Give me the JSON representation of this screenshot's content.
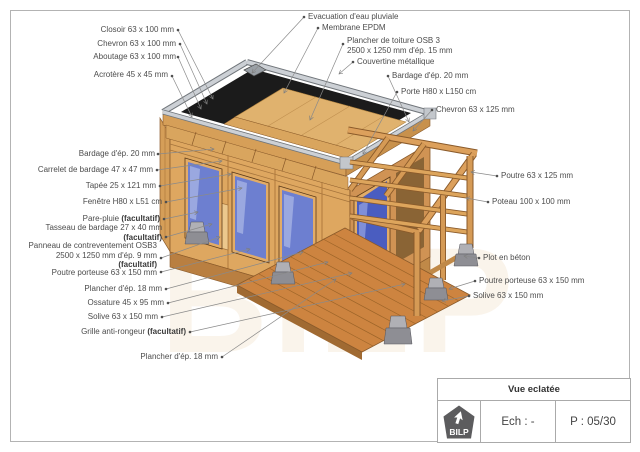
{
  "title_block": {
    "view_name": "Vue eclatée",
    "scale_label": "Ech : -",
    "page_label": "P : 05/30",
    "logo_text": "BILP"
  },
  "watermark": "BILP",
  "labels": {
    "evacuation": {
      "text": "Evacuation d'eau pluviale"
    },
    "membrane": {
      "text": "Membrane EPDM"
    },
    "plancher_toiture": {
      "line1": "Plancher de toiture OSB 3",
      "line2": "2500 x 1250 mm d'ép. 15 mm"
    },
    "couvertine": {
      "text": "Couvertine métallique"
    },
    "bardage_droit": {
      "text": "Bardage d'ép. 20 mm"
    },
    "porte": {
      "text": "Porte H80 x L150 cm"
    },
    "chevron_droit": {
      "text": "Chevron 63 x 125 mm"
    },
    "closoir": {
      "text": "Closoir 63 x 100 mm"
    },
    "chevron_gauche": {
      "text": "Chevron 63 x 100 mm"
    },
    "aboutage": {
      "text": "Aboutage 63 x 100 mm"
    },
    "acrotere": {
      "text": "Acrotère 45 x 45 mm"
    },
    "bardage_gauche": {
      "text": "Bardage d'ép. 20 mm"
    },
    "carrelet": {
      "text": "Carrelet de bardage 47 x 47 mm"
    },
    "tapee": {
      "text": "Tapée 25 x 121 mm"
    },
    "fenetre": {
      "text": "Fenêtre H80 x L51 cm"
    },
    "pare_pluie": {
      "text": "Pare-pluie ",
      "bold": "(facultatif)"
    },
    "tasseau": {
      "line1": "Tasseau de bardage 27 x 40 mm",
      "bold": "(facultatif)"
    },
    "panneau": {
      "line1": "Panneau de contreventement OSB3",
      "line2": "2500 x 1250 mm d'ép. 9 mm",
      "bold": "(facultatif)"
    },
    "poutre_porteuse_gauche": {
      "text": "Poutre porteuse 63 x 150 mm"
    },
    "plancher_gauche": {
      "text": "Plancher d'ép. 18 mm"
    },
    "ossature": {
      "text": "Ossature 45 x 95 mm"
    },
    "solive_gauche": {
      "text": "Solive 63 x 150 mm"
    },
    "grille": {
      "text": "Grille anti-rongeur ",
      "bold": "(facultatif)"
    },
    "plancher_bas": {
      "text": "Plancher d'ép. 18 mm"
    },
    "poutre_droite": {
      "text": "Poutre 63 x 125 mm"
    },
    "poteau": {
      "text": "Poteau 100 x 100 mm"
    },
    "plot": {
      "text": "Plot en béton"
    },
    "poutre_porteuse_droite": {
      "text": "Poutre porteuse 63 x 150 mm"
    },
    "solive_droite": {
      "text": "Solive 63 x 150 mm"
    }
  },
  "colors": {
    "wood": "#dca45f",
    "wood_dark": "#a06a32",
    "osb": "#e0b26e",
    "membrane_epdm": "#1b1b1b",
    "metal_couvertine": "#c9cdd2",
    "window_glass": "#6d7fd0",
    "pare_pluie_blue": "#2236e0",
    "concrete": "#9a9aa0",
    "leader_line": "#8a8a8a",
    "label_text": "#4c4c4c"
  }
}
